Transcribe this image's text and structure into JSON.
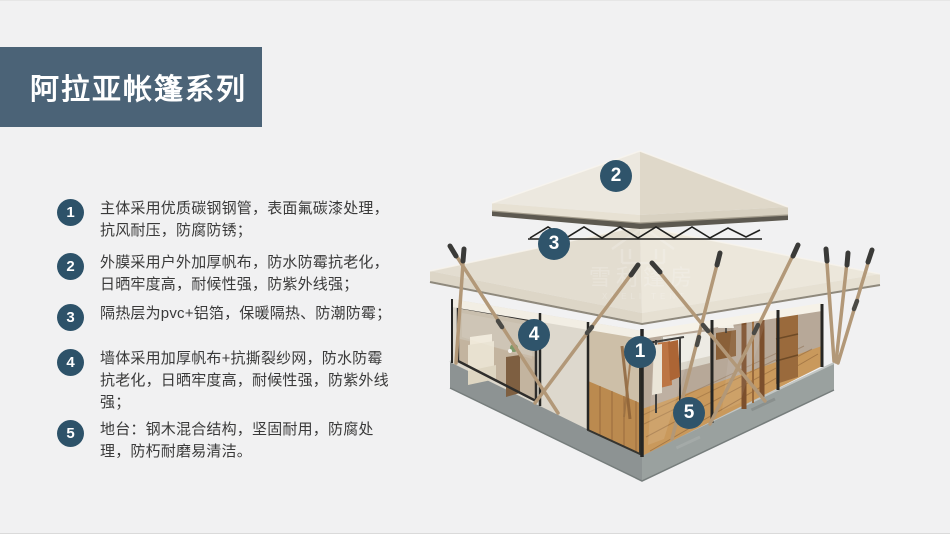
{
  "slide": {
    "background_color": "#f1f1f2",
    "accent_color": "#2d5269",
    "title_bg_color": "#4b6377"
  },
  "title": {
    "text": "阿拉亚帐篷系列"
  },
  "features": [
    {
      "num": "1",
      "text": "主体采用优质碳钢钢管，表面氟碳漆处理，抗风耐压，防腐防锈；"
    },
    {
      "num": "2",
      "text": "外膜采用户外加厚帆布，防水防霉抗老化，日晒牢度高，耐候性强，防紫外线强；"
    },
    {
      "num": "3",
      "text": "隔热层为pvc+铝箔，保暖隔热、防潮防霉；"
    },
    {
      "num": "4",
      "text": "墙体采用加厚帆布+抗撕裂纱网，防水防霉抗老化，日晒牢度高，耐候性强，防紫外线强；"
    },
    {
      "num": "5",
      "text": "地台：钢木混合结构，坚固耐用，防腐处理，防朽耐磨易清洁。"
    }
  ],
  "callouts": [
    {
      "label": "1",
      "target": "tent-frame-pole"
    },
    {
      "label": "2",
      "target": "upper-roof"
    },
    {
      "label": "3",
      "target": "main-roof"
    },
    {
      "label": "4",
      "target": "canvas-wall"
    },
    {
      "label": "5",
      "target": "deck-platform"
    }
  ],
  "watermark": {
    "cn": "雪利篷房",
    "en": "XUELI TENT"
  }
}
